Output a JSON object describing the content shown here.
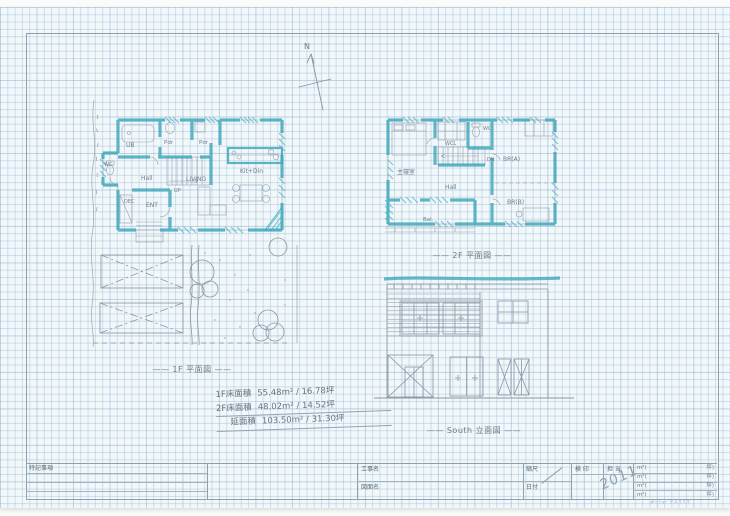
{
  "sheet": {
    "north_label": "N",
    "captions": {
      "plan1f": "—— 1F 平面図 ——",
      "plan2f": "—— 2F 平面図 ——",
      "elevation": "—— South 立面図 ——"
    },
    "area_notes": {
      "lines": [
        {
          "label": "1F床面積",
          "value": "55.48m² / 16.78坪"
        },
        {
          "label": "2F床面積",
          "value": "48.02m² / 14.52坪"
        },
        {
          "label": "延面積",
          "value": "103.50m² / 31.30坪"
        }
      ]
    },
    "brand_text": "#star EA333"
  },
  "plan1f": {
    "rooms": {
      "ub": "UB",
      "pdr1": "Pdr",
      "pdr2": "Pdr",
      "wc": "WC",
      "hall": "Hall",
      "up": "UP",
      "dec": "DEC",
      "ent": "ENT",
      "living": "LIVING",
      "kitdin": "Kit+Din"
    }
  },
  "plan2f": {
    "rooms": {
      "master": "主寝室",
      "wcl": "WCL",
      "wc": "WC",
      "dn": "DN",
      "hall": "Hall",
      "bra": "BR(A)",
      "brb": "BR(B)",
      "bal": "Bal."
    }
  },
  "titleblock": {
    "notes_label": "特記事項",
    "project_label": "工事名",
    "drawing_label": "図面名",
    "scale_label": "縮尺",
    "date_label": "日付",
    "stamp_label": "検 印",
    "charge_label": "担 当",
    "handwritten_date": "2011",
    "unit_left": "m²(",
    "unit_right": "坪)"
  }
}
